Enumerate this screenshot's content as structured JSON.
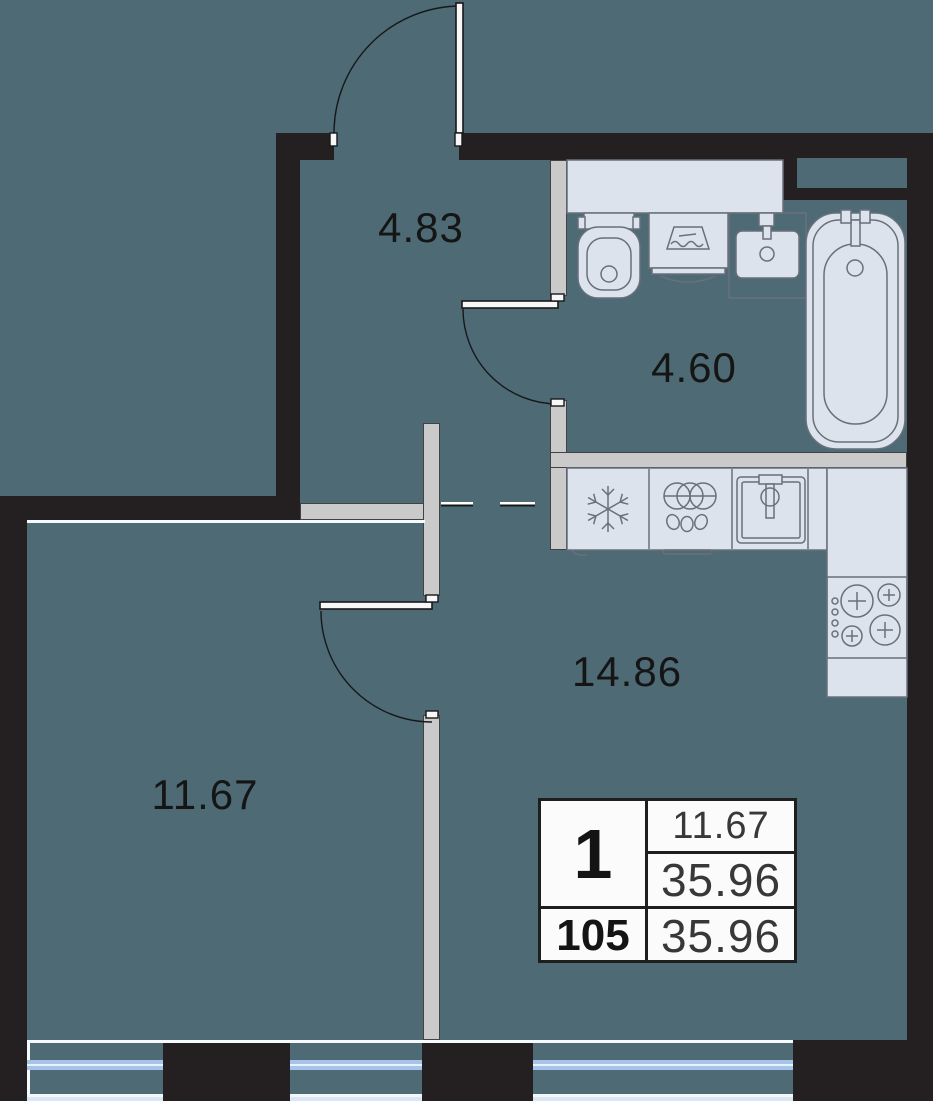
{
  "floorplan": {
    "rooms": [
      {
        "name": "hallway",
        "area_label": "4.83"
      },
      {
        "name": "bathroom",
        "area_label": "4.60"
      },
      {
        "name": "kitchen-living-room",
        "area_label": "14.86"
      },
      {
        "name": "bedroom",
        "area_label": "11.67"
      }
    ],
    "info_table": {
      "room_count": "1",
      "living_area": "11.67",
      "total_area": "35.96",
      "apartment_number": "105",
      "apartment_area": "35.96"
    },
    "fixtures": [
      "toilet",
      "washing-machine",
      "bathroom-sink",
      "bathtub",
      "fridge",
      "dishwasher",
      "kitchen-sink",
      "stove",
      "counter"
    ],
    "colors": {
      "wall": "#241f21",
      "floor": "#4e6a74",
      "partition": "#cacaca",
      "fixture_fill": "#dde3ec",
      "fixture_stroke": "#68707c",
      "window_glass": "#a6c3ea",
      "table_background": "#fbfbfb"
    }
  }
}
